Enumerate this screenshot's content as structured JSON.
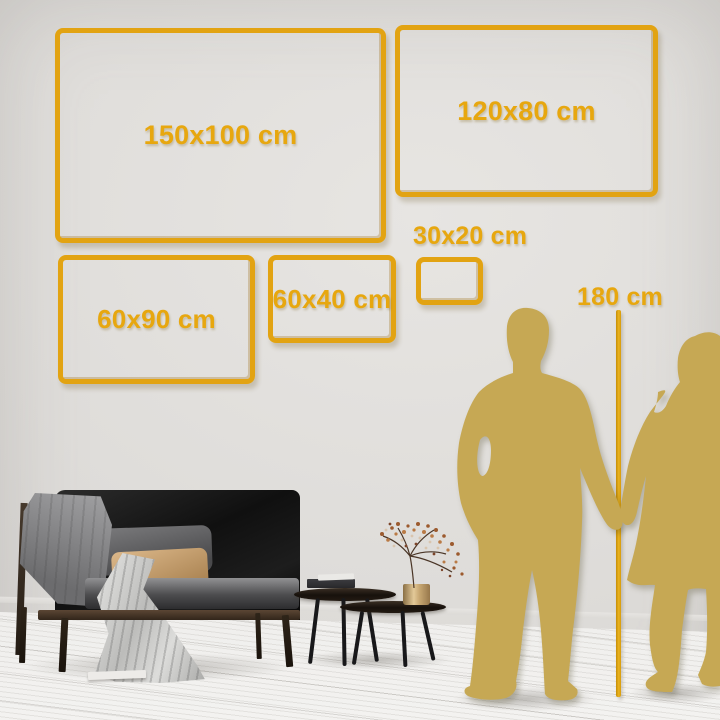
{
  "meta": {
    "title": "Wall art size comparison in living room"
  },
  "sizes": [
    {
      "id": "150x100",
      "label": "150x100 cm",
      "width_cm": 150,
      "height_cm": 100
    },
    {
      "id": "120x80",
      "label": "120x80 cm",
      "width_cm": 120,
      "height_cm": 80
    },
    {
      "id": "60x90",
      "label": "60x90 cm",
      "width_cm": 90,
      "height_cm": 60
    },
    {
      "id": "60x40",
      "label": "60x40 cm",
      "width_cm": 60,
      "height_cm": 40
    },
    {
      "id": "30x20",
      "label": "30x20 cm",
      "width_cm": 30,
      "height_cm": 20
    }
  ],
  "reference": {
    "height_label": "180 cm",
    "height_cm": 180
  },
  "colors": {
    "accent_gold": "#e2a312",
    "silhouette_gold": "#c6a854",
    "wall": "#dedcd9",
    "floor": "#f1f0ee"
  },
  "icons": [
    "man-silhouette-icon",
    "woman-silhouette-icon",
    "height-ruler-line"
  ]
}
